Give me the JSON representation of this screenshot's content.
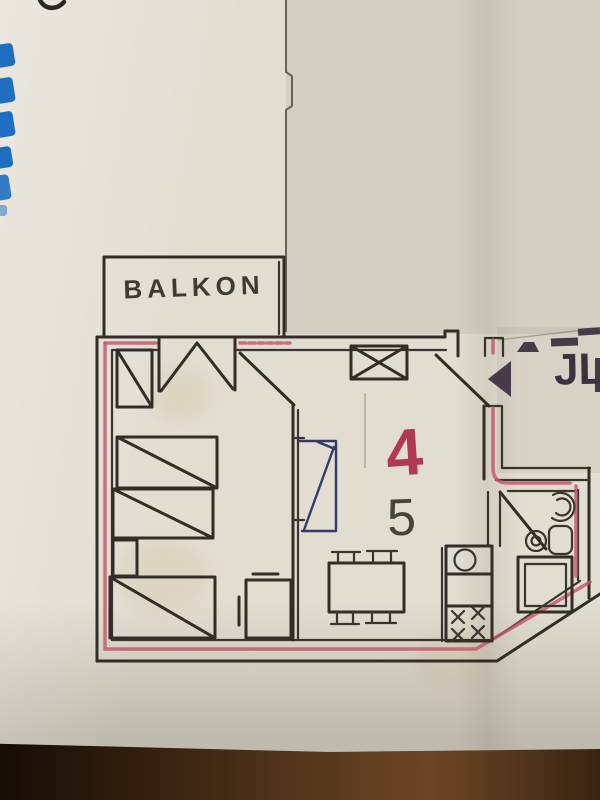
{
  "photo": {
    "subject": "hand-drawn apartment floor plan photographed on a wooden table"
  },
  "floor_plan": {
    "balcony_label": "BALKON",
    "red_unit_number": "4",
    "black_number": "5",
    "partial_text_right": "JL",
    "colors": {
      "ink": "#322d27",
      "red_marker_line": "#c4556b",
      "red_number": "#b13a52",
      "blue_pen_sofa": "#333b6d",
      "blue_edge_marks": "#1e6ec1",
      "dark_stamp_marks": "#473b49",
      "paper": "#e2ddd1",
      "wood_table": "#54361c"
    },
    "elements": [
      "balcony",
      "bedroom",
      "living-room",
      "kitchen-unit",
      "bathroom",
      "entry-hall",
      "wardrobe",
      "bed",
      "bed",
      "bed",
      "nightstand",
      "cabinet",
      "sofa",
      "dining-table-with-chairs",
      "sink-circle",
      "stove-burners",
      "toilet",
      "washbasin",
      "shower-square",
      "balcony-door-symbol",
      "entry-door-swing",
      "bedroom-door-swing",
      "bathroom-door-swing",
      "window-x-box"
    ]
  }
}
